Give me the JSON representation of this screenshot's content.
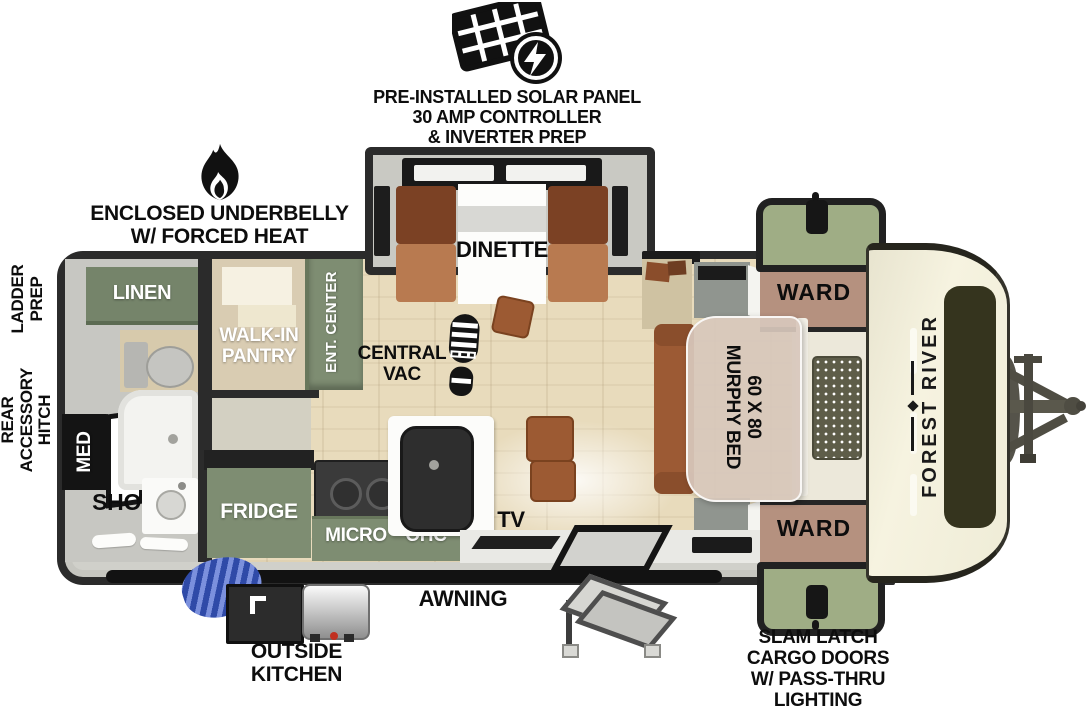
{
  "annotations": {
    "solar": {
      "lines": [
        "PRE-INSTALLED SOLAR PANEL",
        "30 AMP CONTROLLER",
        "& INVERTER PREP"
      ]
    },
    "underbelly": {
      "lines": [
        "ENCLOSED UNDERBELLY",
        "W/ FORCED HEAT"
      ]
    },
    "ladder_prep": {
      "lines": [
        "LADDER",
        "PREP"
      ]
    },
    "rear_accessory_hitch": {
      "lines": [
        "REAR",
        "ACCESSORY",
        "HITCH"
      ]
    },
    "awning": "AWNING",
    "outside_kitchen": {
      "lines": [
        "OUTSIDE",
        "KITCHEN"
      ]
    },
    "slam_latch": {
      "lines": [
        "SLAM LATCH",
        "CARGO DOORS",
        "W/ PASS-THRU",
        "LIGHTING"
      ]
    },
    "central_vac": {
      "lines": [
        "CENTRAL",
        "VAC"
      ]
    }
  },
  "rooms": {
    "dinette": "DINETTE",
    "linen": "LINEN",
    "walk_in_pantry": {
      "lines": [
        "WALK-IN",
        "PANTRY"
      ]
    },
    "ent_center": "ENT. CENTER",
    "med": "MED",
    "shower": "SHOWER",
    "fridge": "FRIDGE",
    "micro": "MICRO",
    "ohc": "OHC",
    "tv": "TV",
    "ward_top": "WARD",
    "ward_bottom": "WARD",
    "murphy_bed": {
      "lines": [
        "60 X 80",
        "MURPHY BED"
      ]
    }
  },
  "brand": {
    "front_cap": "FOREST RIVER"
  },
  "colors": {
    "outline": "#2b2b2b",
    "cabinet_green": "#7e8d72",
    "linen_green": "#75846a",
    "exterior_door_green": "#9fad85",
    "floor_wood": "#e8dbbc",
    "bath_floor": "#c7c7c2",
    "ward_brown": "#b5917f",
    "sofa_brown": "#9c5a34",
    "bench_dark_brown": "#7b4124",
    "bench_light_brown": "#b87a50",
    "front_cap_cream": "#f3efdd",
    "decal_olive": "#35341e",
    "hose_blue": "#2f4aa8",
    "murphy_overlay": "#d7c7bb"
  }
}
